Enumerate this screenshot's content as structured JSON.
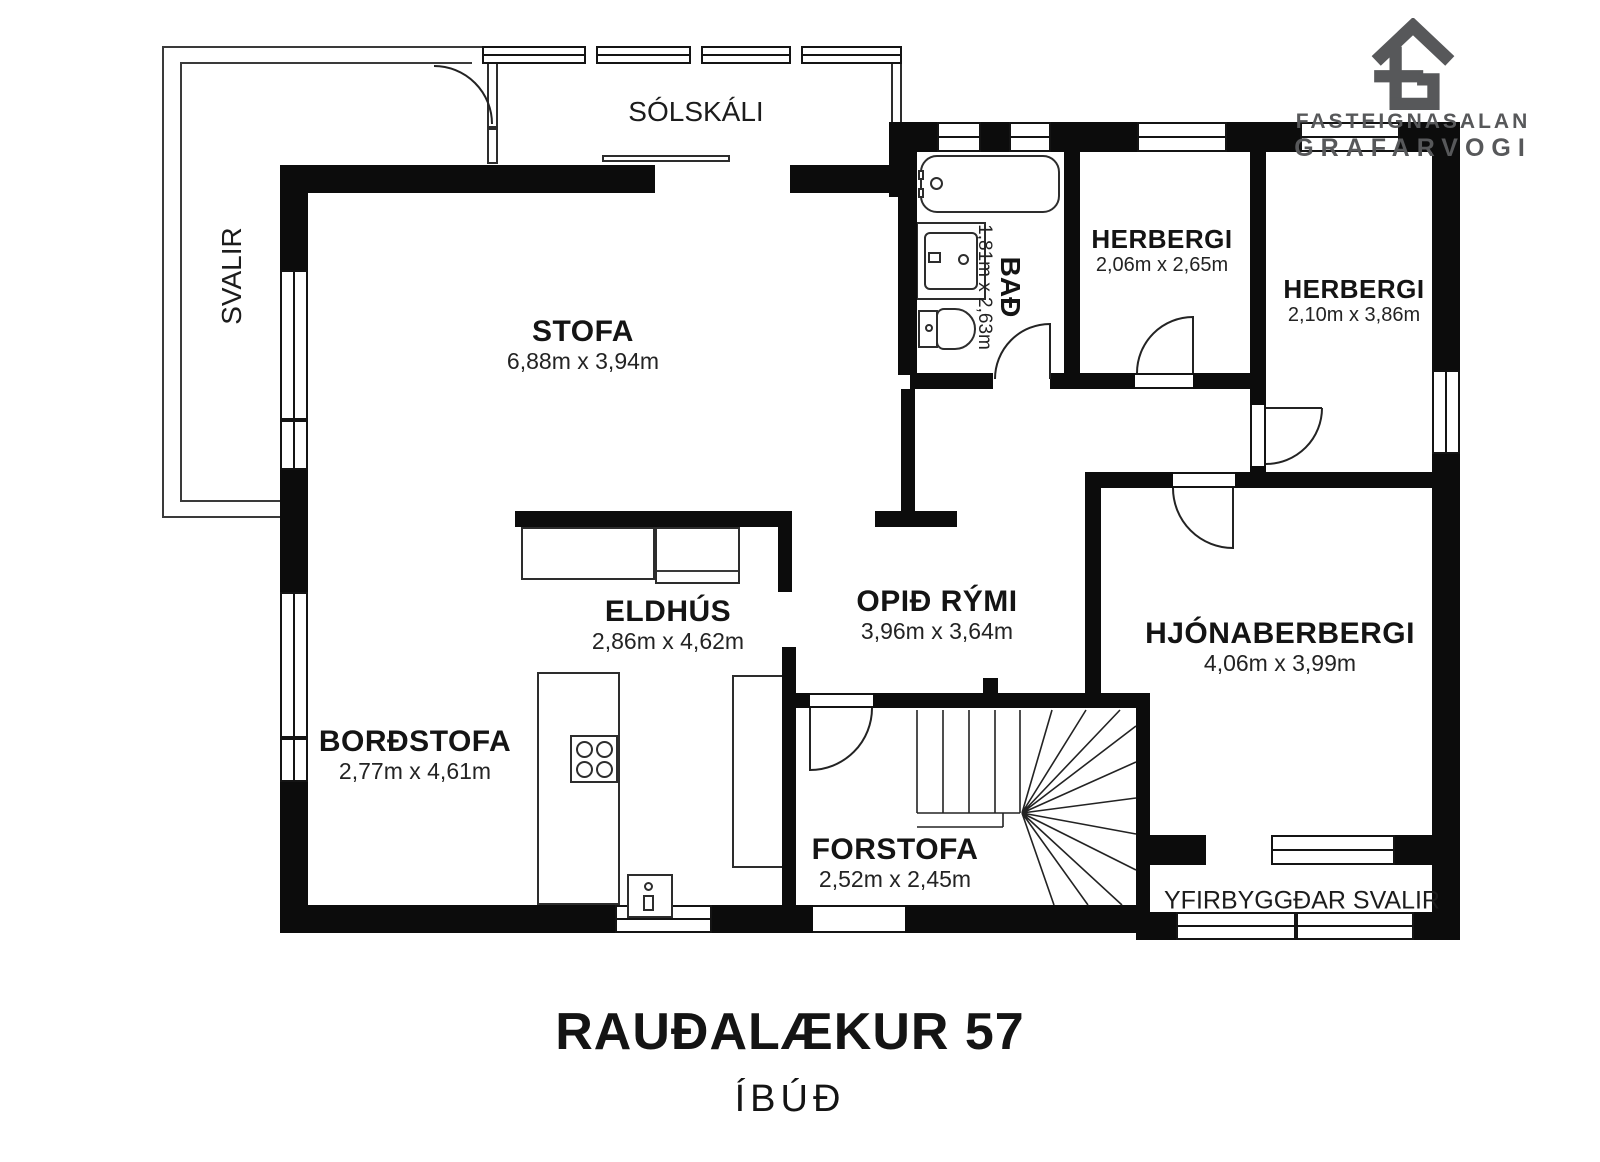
{
  "title": {
    "address": "RAUÐALÆKUR 57",
    "unit": "ÍBÚÐ"
  },
  "logo": {
    "line1": "FASTEIGNASALAN",
    "line2": "GRAFARVOGI",
    "color": "#57585a",
    "icon": "house-logo-icon"
  },
  "rooms": {
    "stofa": {
      "name": "STOFA",
      "dims": "6,88m x 3,94m"
    },
    "solskali": {
      "name": "SÓLSKÁLI"
    },
    "svalir": {
      "name": "SVALIR"
    },
    "bad": {
      "name": "BAÐ",
      "dims": "1,81m x 2,63m"
    },
    "herbergi1": {
      "name": "HERBERGI",
      "dims": "2,06m x 2,65m"
    },
    "herbergi2": {
      "name": "HERBERGI",
      "dims": "2,10m x 3,86m"
    },
    "eldhus": {
      "name": "ELDHÚS",
      "dims": "2,86m x 4,62m"
    },
    "opid_rymi": {
      "name": "OPIÐ RÝMI",
      "dims": "3,96m x 3,64m"
    },
    "bordstofa": {
      "name": "BORÐSTOFA",
      "dims": "2,77m x 4,61m"
    },
    "hjonaberbergi": {
      "name": "HJÓNABERBERGI",
      "dims": "4,06m x 3,99m"
    },
    "forstofa": {
      "name": "FORSTOFA",
      "dims": "2,52m x 2,45m"
    },
    "yfirbyggdar": {
      "name": "YFIRBYGGÐAR SVALIR"
    }
  },
  "colors": {
    "wall": "#0c0c0c",
    "line": "#2d2d2d",
    "logo_gray": "#57585a"
  }
}
